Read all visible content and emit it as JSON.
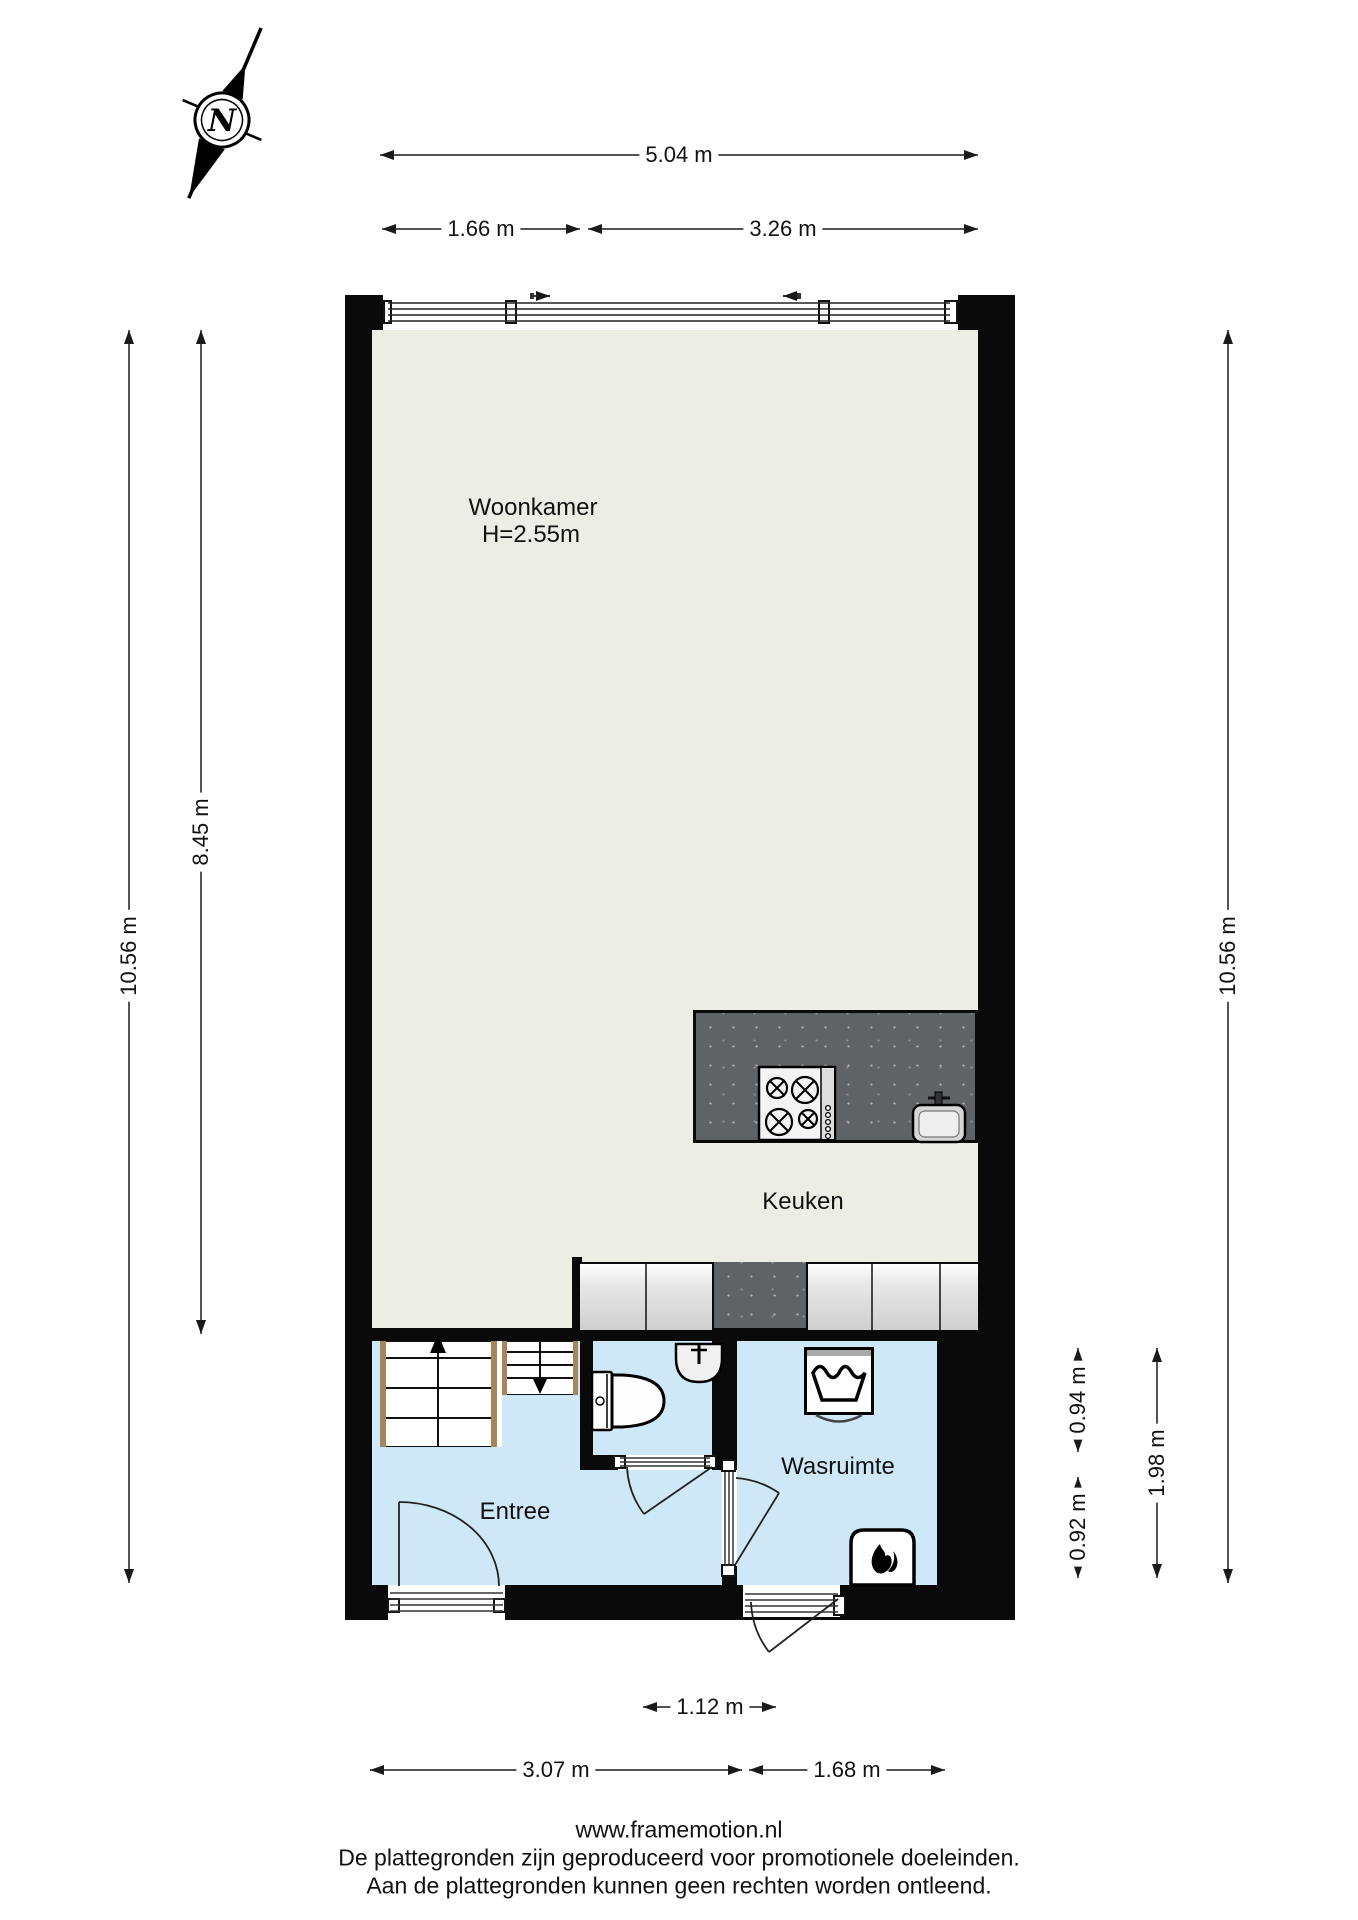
{
  "title": "Floor plan",
  "compass": {
    "label": "N"
  },
  "rooms": {
    "woonkamer": {
      "name": "Woonkamer",
      "ceiling_height": "H=2.55m"
    },
    "keuken": {
      "name": "Keuken"
    },
    "entree": {
      "name": "Entree"
    },
    "wasruimte": {
      "name": "Wasruimte"
    }
  },
  "dimensions": {
    "top_total": "5.04 m",
    "top_left": "1.66 m",
    "top_right": "3.26 m",
    "left_total": "10.56 m",
    "left_inner": "8.45 m",
    "right_total": "10.56 m",
    "right_upper": "0.94 m",
    "right_lower": "0.92 m",
    "right_span": "1.98 m",
    "bottom_center": "1.12 m",
    "bottom_left": "3.07 m",
    "bottom_right": "1.68 m"
  },
  "footer": {
    "website": "www.framemotion.nl",
    "disclaimer1": "De plattegronden zijn geproduceerd voor promotionele doeleinden.",
    "disclaimer2": "Aan de plattegronden kunnen geen rechten worden ontleend."
  },
  "colors": {
    "wall": "#0a0a0a",
    "living_floor": "#ecede4",
    "wet_floor": "#cfe8f8",
    "counter_dark": "#606365",
    "counter_light": "#d9d9d9",
    "stair_stringer": "#a6845c",
    "line": "#1a1a1a"
  },
  "icons": [
    "compass-north-icon",
    "window-slide-arrow-icon",
    "stairs-up-arrow-icon",
    "stairs-down-arrow-icon",
    "stove-icon",
    "kitchen-sink-icon",
    "toilet-icon",
    "washbasin-icon",
    "washing-machine-icon",
    "boiler-icon",
    "door-swing-icon"
  ]
}
